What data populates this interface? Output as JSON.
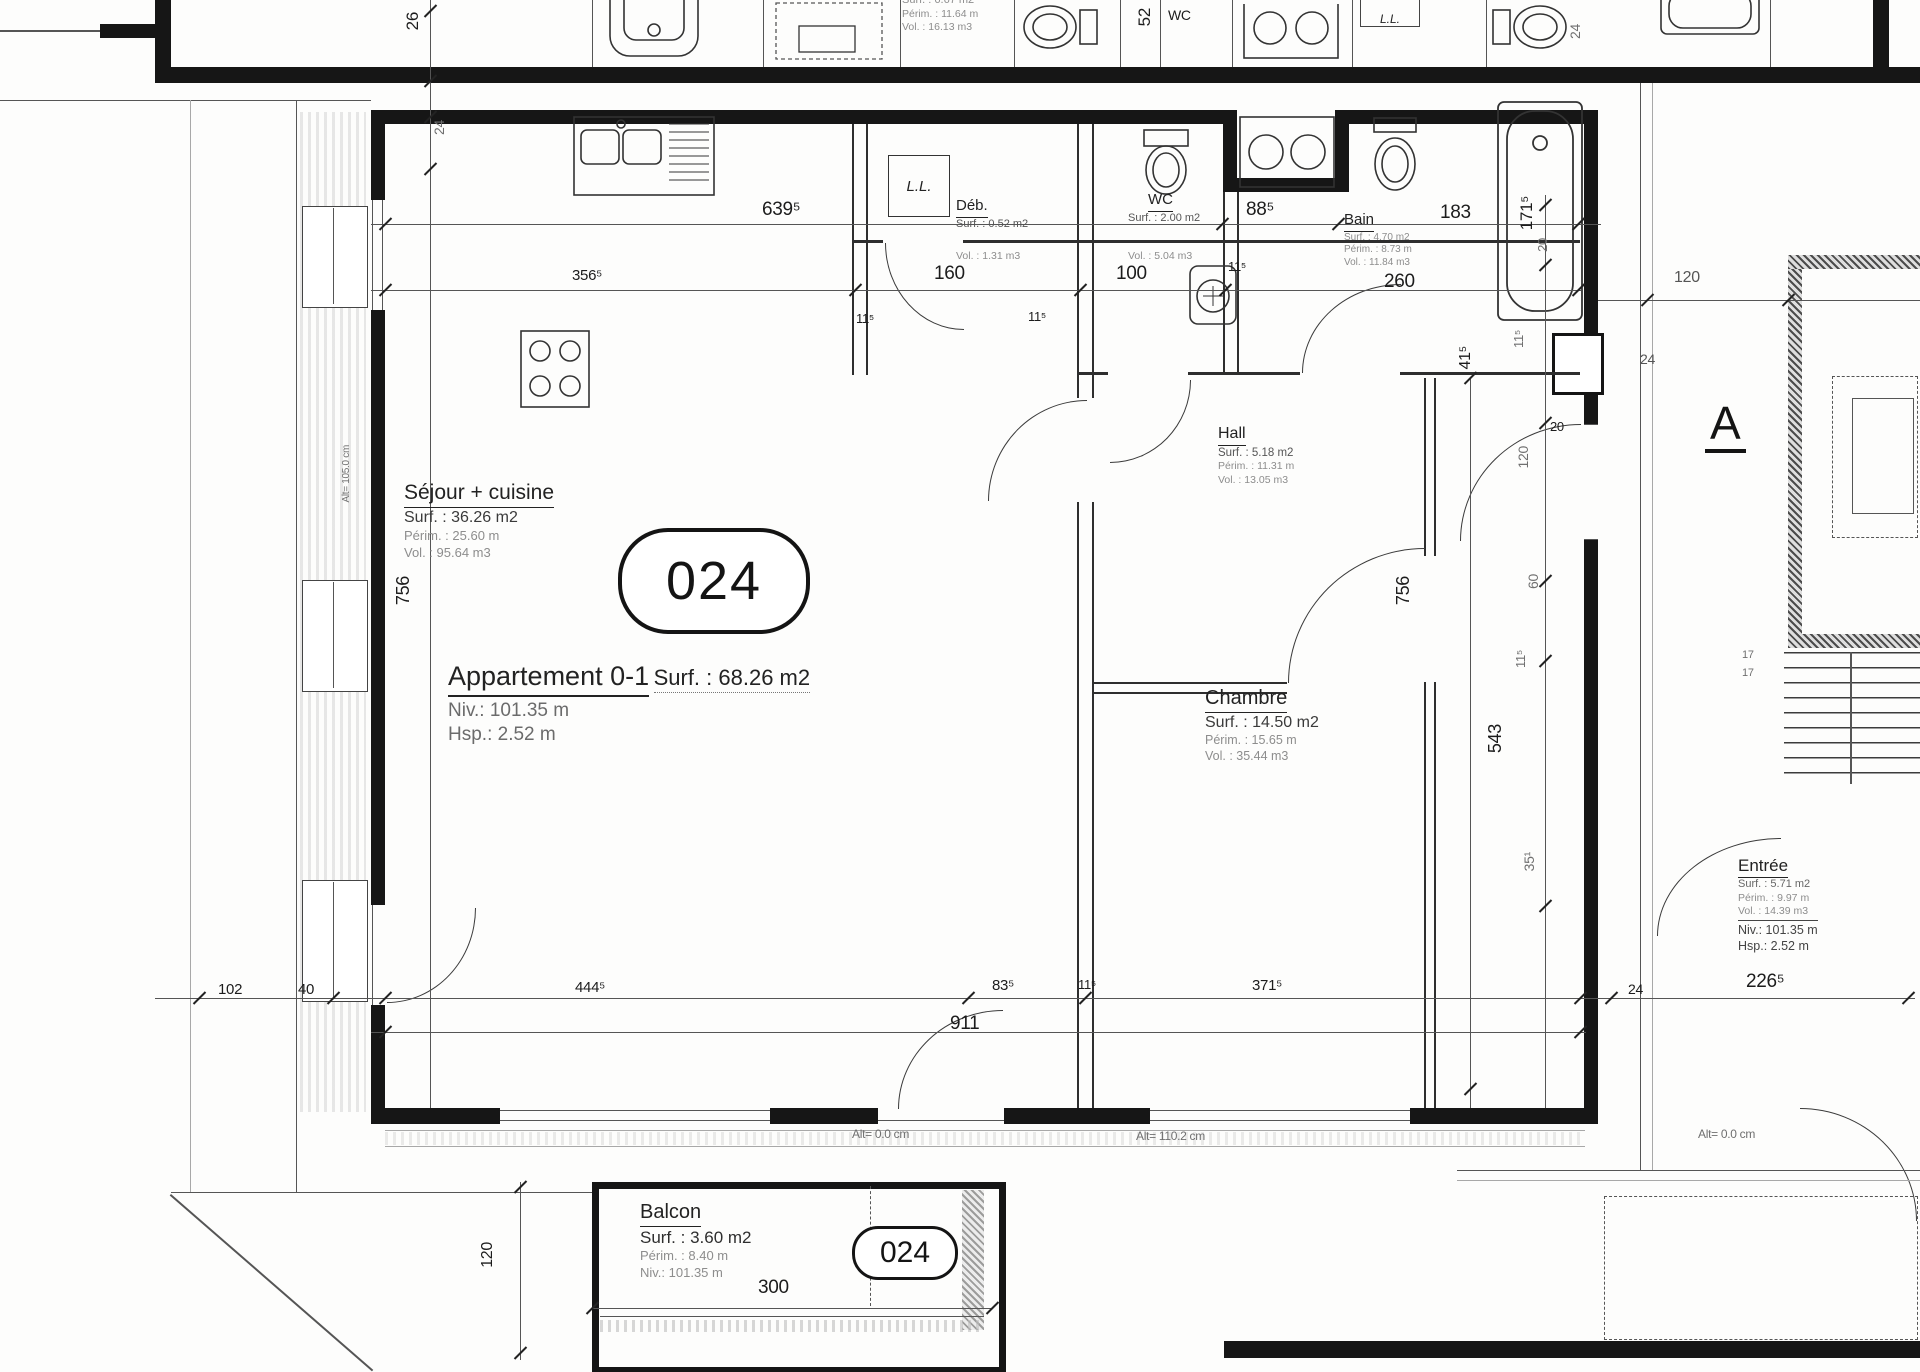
{
  "apartment": {
    "badge": "024",
    "name": "Appartement 0-1",
    "surface": "Surf. : 68.26 m2",
    "level": "Niv.: 101.35 m",
    "height": "Hsp.: 2.52 m"
  },
  "rooms": {
    "sejour": {
      "name": "Séjour + cuisine",
      "surface": "Surf. : 36.26 m2",
      "perimeter": "Périm. : 25.60 m",
      "volume": "Vol. : 95.64 m3"
    },
    "chambre": {
      "name": "Chambre",
      "surface": "Surf. : 14.50 m2",
      "perimeter": "Périm. : 15.65 m",
      "volume": "Vol. : 35.44 m3"
    },
    "hall": {
      "name": "Hall",
      "surface": "Surf. : 5.18 m2",
      "perimeter": "Périm. : 11.31 m",
      "volume": "Vol. : 13.05 m3"
    },
    "deb": {
      "name": "Déb.",
      "surface": "Surf. : 0.52 m2",
      "volume": "Vol. : 1.31 m3"
    },
    "wc": {
      "name": "WC",
      "surface": "Surf. : 2.00 m2",
      "volume": "Vol. : 5.04 m3"
    },
    "bain": {
      "name": "Bain",
      "surface": "Surf. : 4.70 m2",
      "perimeter": "Périm. : 8.73 m",
      "volume": "Vol. : 11.84 m3"
    },
    "entree": {
      "name": "Entrée",
      "surface": "Surf. : 5.71 m2",
      "perimeter": "Périm. : 9.97 m",
      "volume": "Vol. : 14.39 m3",
      "level": "Niv.: 101.35 m",
      "height": "Hsp.: 2.52 m"
    },
    "balcon": {
      "name": "Balcon",
      "surface": "Surf. : 3.60 m2",
      "perimeter": "Périm. : 8.40 m",
      "level": "Niv.: 101.35 m",
      "badge": "024"
    },
    "neighbor": {
      "surface": "Surf. : 6.67 m2",
      "perimeter": "Périm. : 11.64 m",
      "volume": "Vol. : 16.13 m3"
    }
  },
  "labels": {
    "block": "A",
    "wc_top": "WC",
    "lave_linge": "L.L.",
    "stair_count": "17",
    "alt_zero": "Alt= 0.0 cm",
    "alt_110": "Alt= 110.2 cm",
    "alt_105": "Alt= 105.0 cm"
  },
  "dims": {
    "t26": "26",
    "t24": "24",
    "w639": "639⁵",
    "w88": "88⁵",
    "w183": "183",
    "v171": "171⁵",
    "v20": "20",
    "w356": "356⁵",
    "w160": "160",
    "w100": "100",
    "w11a": "11⁵",
    "w260": "260",
    "w11b": "11⁵",
    "w11c": "11⁵",
    "v756": "756",
    "v41": "41⁵",
    "v11d": "11⁵",
    "w20": "20",
    "v120": "120",
    "v60": "60",
    "v11e": "11⁵",
    "v543": "543",
    "v35": "35¹",
    "w102": "102",
    "w40": "40",
    "w444": "444⁵",
    "w83": "83⁵",
    "w11f": "11⁵",
    "w371": "371⁵",
    "w911": "911",
    "w24": "24",
    "w226": "226⁵",
    "w120r": "120",
    "w24r": "24",
    "v52": "52",
    "v24c": "24",
    "v120b": "120",
    "w300": "300"
  }
}
